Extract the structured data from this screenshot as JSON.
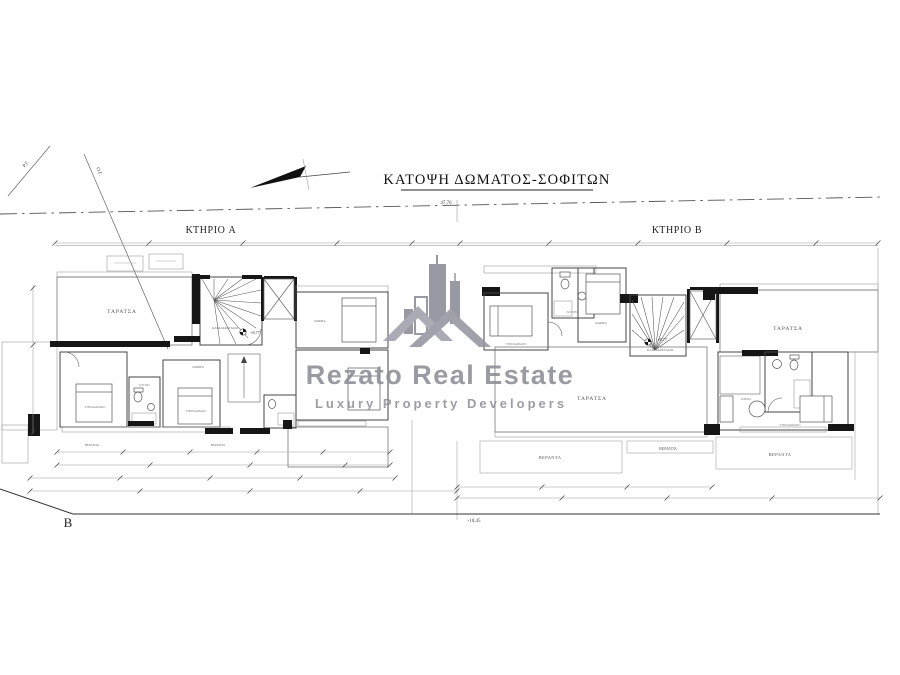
{
  "title": "ΚΑΤΟΨΗ ΔΩΜΑΤΟΣ-ΣΟΦΙΤΩΝ",
  "buildings": {
    "a": "ΚΤΗΡΙΟ A",
    "b": "ΚΤΗΡΙΟ B"
  },
  "rooms": {
    "terrace": "ΤΑΡΑΤΣΑ",
    "veranda": "ΒΕΡΑΝΤΑ",
    "stairwell": "ΚΛΙΜΑΚΟΣΤΑΣΙΟ",
    "attic": "ΣΟΦΙΤΑ",
    "bedroom": "ΥΠΝΟΔΩΜΑΤΙΟ",
    "bathroom": "ΛΟΥΤΡΟ"
  },
  "annotations": {
    "stair_level": "+8,77",
    "plot_width": "47,76",
    "road_level": "-10,45",
    "point_b": "B",
    "boundary_line_1": "Ρ.Γ.",
    "boundary_line_2": "Ο.Γ."
  },
  "watermark": {
    "name": "Rezato Real Estate",
    "tagline": "Luxury  Property  Developers"
  },
  "colors": {
    "plan_line": "#444444",
    "wall_fill": "#161616",
    "grid_line": "#c6c6c6",
    "watermark_gray": "#8d8d97"
  }
}
